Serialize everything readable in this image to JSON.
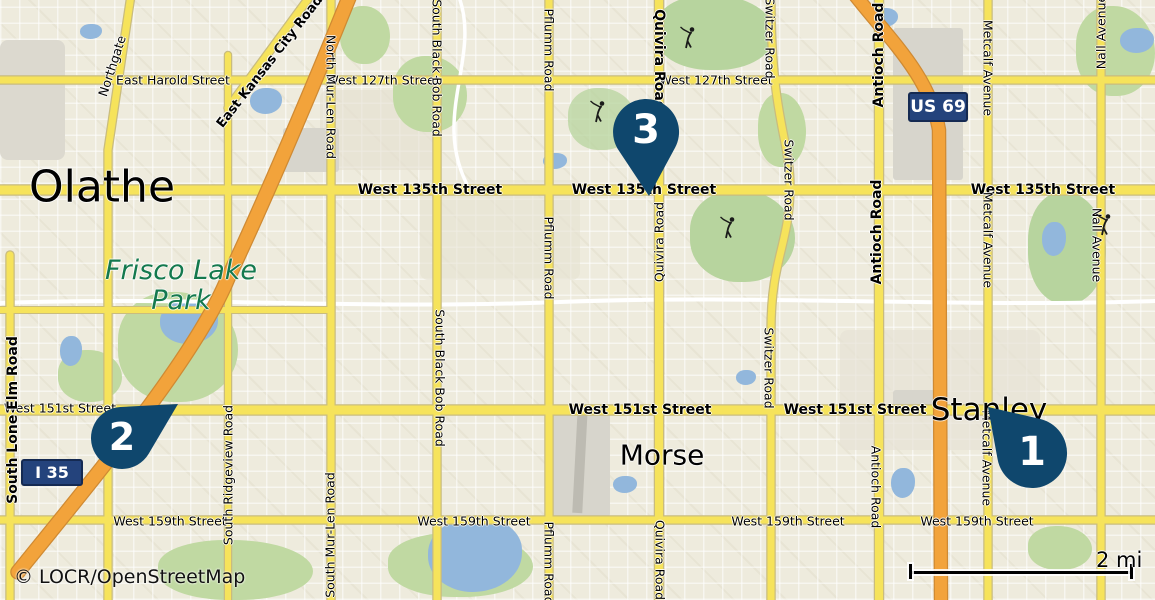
{
  "map": {
    "attribution": "© LOCR/OpenStreetMap",
    "scale": {
      "label": "2 mi"
    },
    "city_labels": [
      {
        "text": "Olathe"
      },
      {
        "text": "Frisco Lake Park"
      },
      {
        "text": "Morse"
      },
      {
        "text": "Stanley"
      }
    ],
    "highway_shields": [
      {
        "name": "US 69"
      },
      {
        "name": "I 35"
      }
    ],
    "markers": [
      {
        "number": "1"
      },
      {
        "number": "2"
      },
      {
        "number": "3"
      }
    ],
    "street_labels": [
      {
        "text": "Northgate"
      },
      {
        "text": "East Harold Street"
      },
      {
        "text": "East Kansas City Road"
      },
      {
        "text": "West 127th Street"
      },
      {
        "text": "West 127th Street"
      },
      {
        "text": "North Mur-Len Road"
      },
      {
        "text": "West 135th Street"
      },
      {
        "text": "West 135th Street"
      },
      {
        "text": "West 135th Street"
      },
      {
        "text": "South Black Bob Road"
      },
      {
        "text": "South Black Bob Road"
      },
      {
        "text": "Pflumm Road"
      },
      {
        "text": "Pflumm Road"
      },
      {
        "text": "Pflumm Road"
      },
      {
        "text": "Quivira Road"
      },
      {
        "text": "Quivira Road"
      },
      {
        "text": "Quivira Road"
      },
      {
        "text": "Switzer Road"
      },
      {
        "text": "Switzer Road"
      },
      {
        "text": "Switzer Road"
      },
      {
        "text": "Antioch Road"
      },
      {
        "text": "Antioch Road"
      },
      {
        "text": "Antioch Road"
      },
      {
        "text": "Metcalf Avenue"
      },
      {
        "text": "Metcalf Avenue"
      },
      {
        "text": "Metcalf Avenue"
      },
      {
        "text": "Nall Avenue"
      },
      {
        "text": "Nall Avenue"
      },
      {
        "text": "West 151st Street"
      },
      {
        "text": "West 151st Street"
      },
      {
        "text": "West 151st Street"
      },
      {
        "text": "West 159th Street"
      },
      {
        "text": "West 159th Street"
      },
      {
        "text": "West 159th Street"
      },
      {
        "text": "West 159th Street"
      },
      {
        "text": "South Lone Elm Road"
      },
      {
        "text": "South Ridgeview Road"
      },
      {
        "text": "South Mur-Len Road"
      }
    ],
    "icons": {
      "golfer": "golfer-swinging-icon",
      "marker": "map-pin"
    },
    "colors": {
      "marker": "#0f476d",
      "shield_bg": "#24437c",
      "major_road": "#f6e35b",
      "highway": "#f2a33b",
      "water": "#92b7dc",
      "park": "#c0d9a2",
      "park_label_text": "#14794e"
    }
  }
}
